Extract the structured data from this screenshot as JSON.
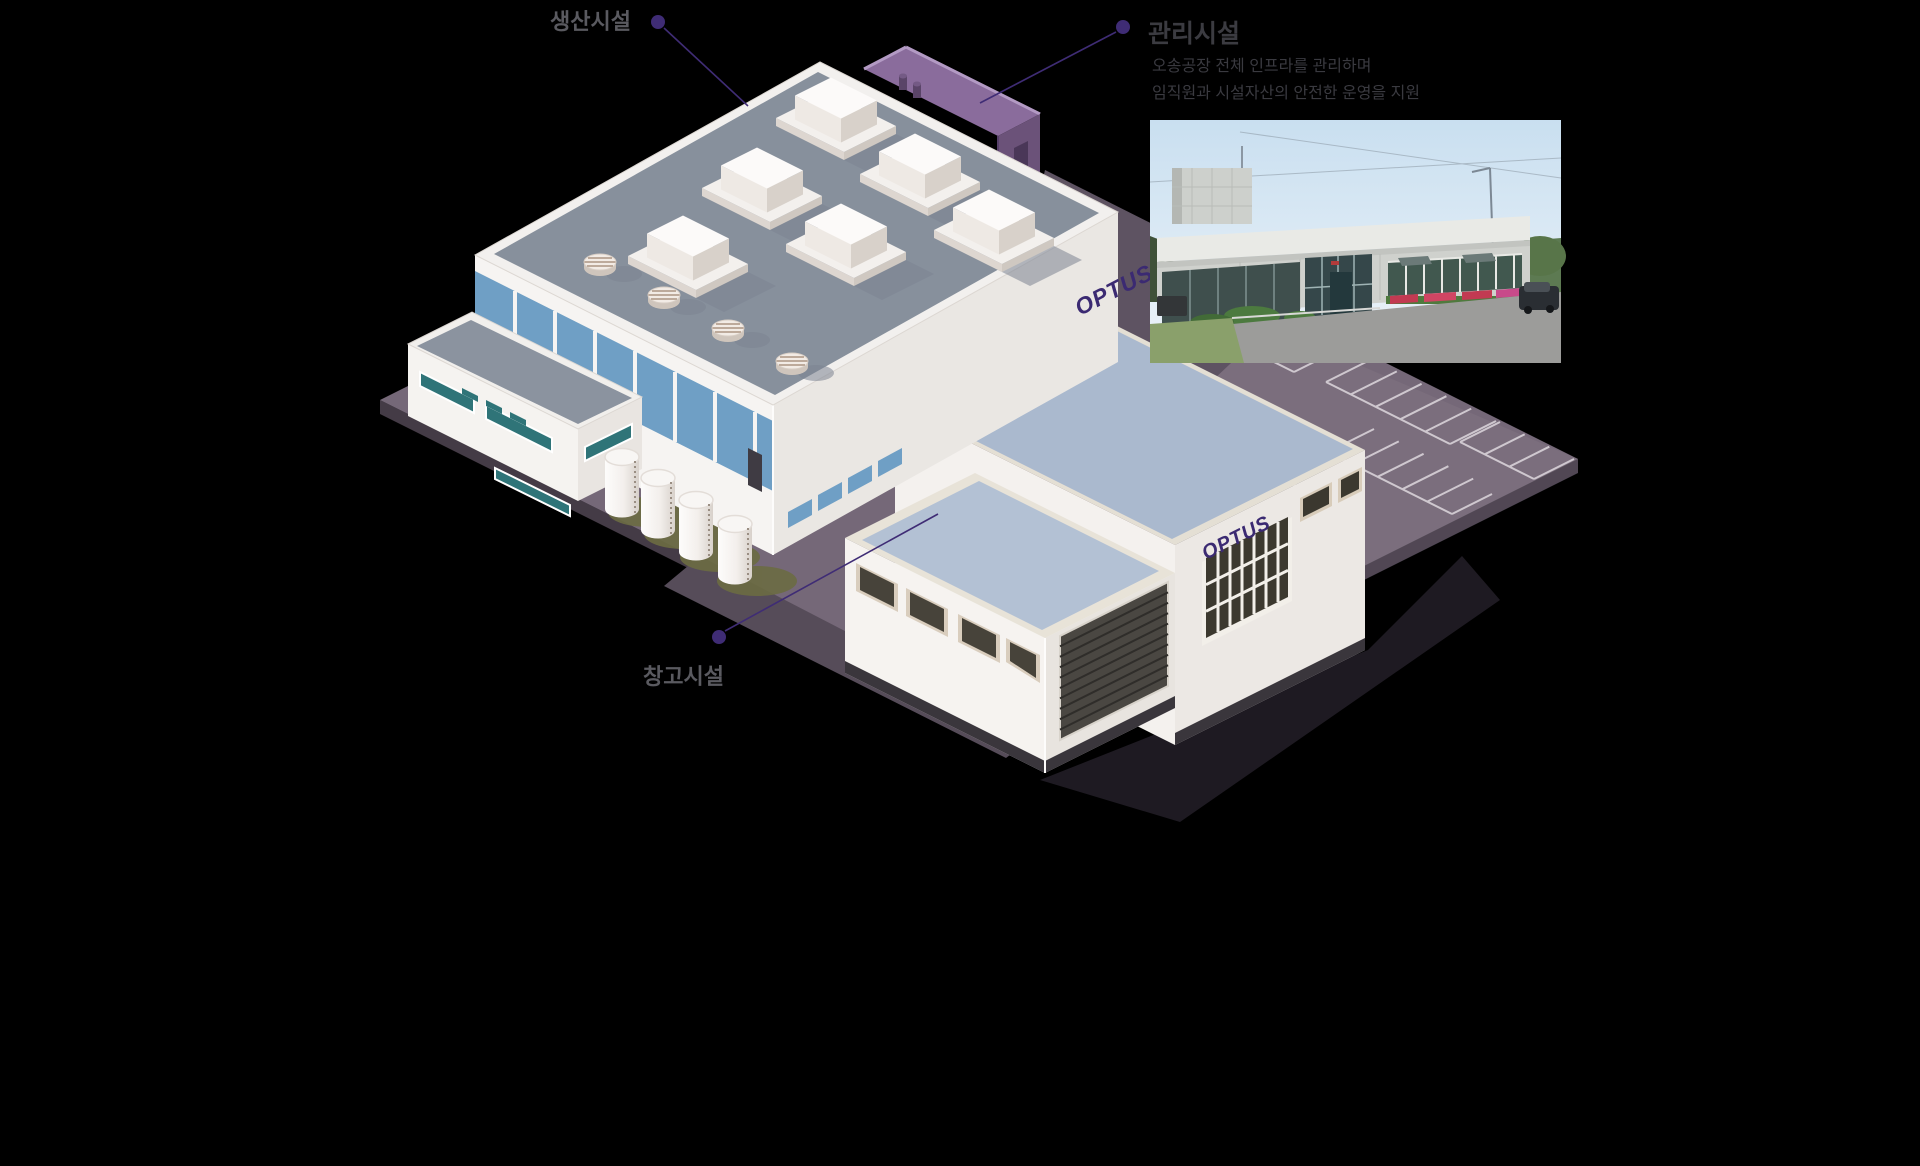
{
  "page": {
    "background": "#000000"
  },
  "annotations": {
    "production": {
      "label": "생산시설"
    },
    "management": {
      "label": "관리시설",
      "description_line1": "오송공장 전체 인프라를 관리하며",
      "description_line2": "임직원과 시설자산의 안전한 운영을 지원"
    },
    "warehouse": {
      "label": "창고시설"
    }
  },
  "logos": {
    "main_building": "OPTUS",
    "warehouse_building": "OPTUS"
  },
  "photo": {
    "name": "management-facility-photo"
  },
  "colors": {
    "accent_purple": "#3F2C75",
    "logo_purple": "#3B2A72",
    "ground": "#756878",
    "ground_side": "#473E49",
    "parking_line": "#D6CFD6",
    "main_roof": "#87909C",
    "window_blue": "#6F9FC5",
    "warehouse_roof": "#AAB9CE",
    "management_purple": "#8A6C9C",
    "label_gray": "#5A5A60",
    "title_gray": "#3B3B41"
  }
}
